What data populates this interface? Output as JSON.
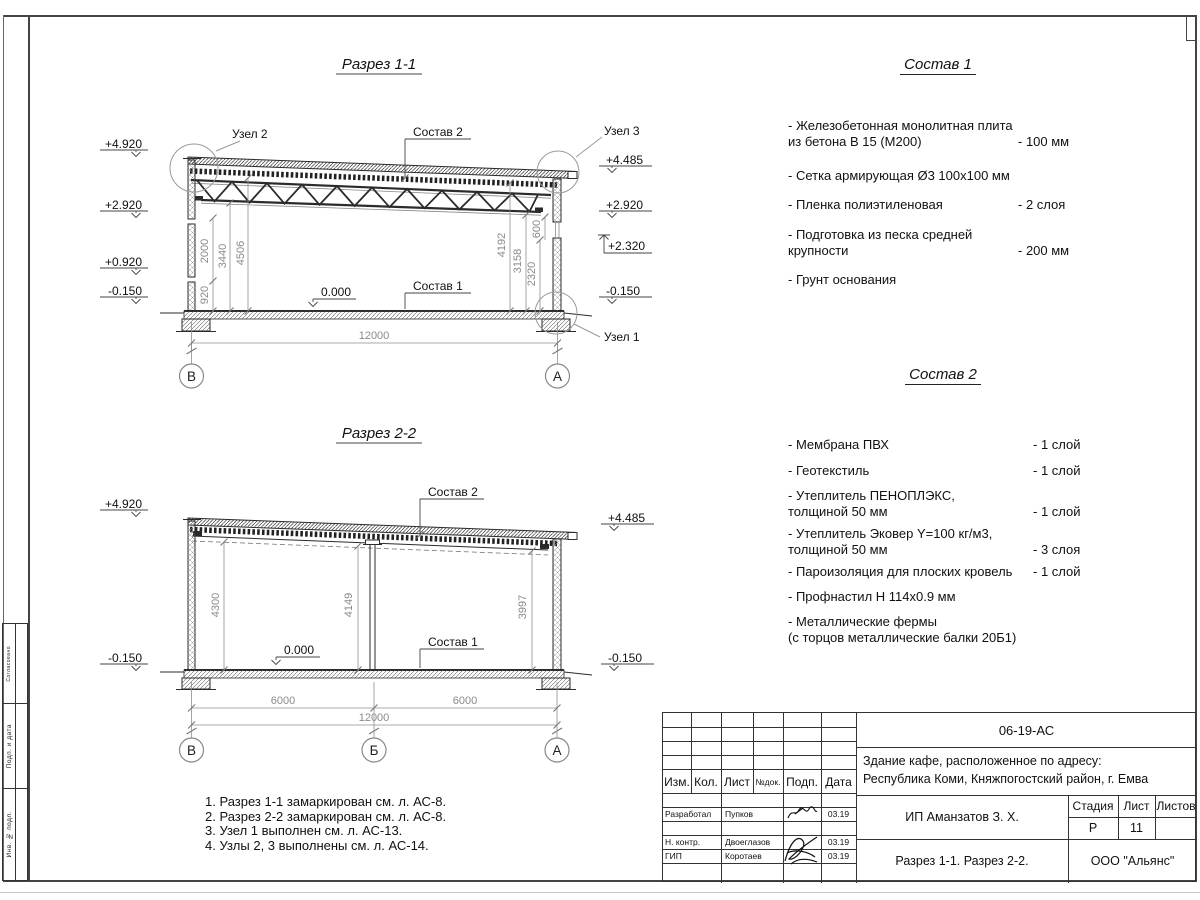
{
  "colors": {
    "ink": "#1c1c1c",
    "dim_text": "#8a8a8a",
    "frame": "#444444"
  },
  "s1": {
    "title": "Разрез 1-1",
    "elev_left": [
      "+4.920",
      "+2.920",
      "+0.920",
      "-0.150"
    ],
    "elev_right": [
      "+4.485",
      "+2.920",
      "+2.320",
      "-0.150"
    ],
    "dims_left": [
      "920",
      "2000",
      "3440",
      "4506"
    ],
    "dims_right": [
      "4192",
      "3158",
      "2320",
      "600"
    ],
    "dim_span": "12000",
    "zero_mark": "0.000",
    "label_sostav1": "Состав 1",
    "label_sostav2": "Состав 2",
    "label_uzel1": "Узел 1",
    "label_uzel2": "Узел 2",
    "label_uzel3": "Узел 3",
    "axis_left": "В",
    "axis_right": "А"
  },
  "s2": {
    "title": "Разрез 2-2",
    "elev_left": [
      "+4.920",
      "-0.150"
    ],
    "elev_right": [
      "+4.485",
      "-0.150"
    ],
    "dims_vert": [
      "4300",
      "4149",
      "3997"
    ],
    "dims_bottom": [
      "6000",
      "6000"
    ],
    "dim_span": "12000",
    "zero_mark": "0.000",
    "label_sostav1": "Состав 1",
    "label_sostav2": "Состав 2",
    "axes": [
      "В",
      "Б",
      "А"
    ]
  },
  "sostav1": {
    "title": "Состав 1",
    "items": [
      {
        "nm": "- Железобетонная  монолитная плита\nиз бетона В 15 (М200)",
        "val": "- 100 мм"
      },
      {
        "nm": "- Сетка армирующая Ø3 100х100 мм",
        "val": ""
      },
      {
        "nm": "- Пленка полиэтиленовая",
        "val": "-  2 слоя"
      },
      {
        "nm": "- Подготовка из песка средней\nкрупности",
        "val": "- 200 мм"
      },
      {
        "nm": "- Грунт основания",
        "val": ""
      }
    ]
  },
  "sostav2": {
    "title": "Состав 2",
    "items": [
      {
        "nm": "- Мембрана ПВХ",
        "val": "- 1 слой"
      },
      {
        "nm": "- Геотекстиль",
        "val": "- 1 слой"
      },
      {
        "nm": "- Утеплитель ПЕНОПЛЭКС,\nтолщиной 50 мм",
        "val": "- 1 слой"
      },
      {
        "nm": "- Утеплитель Эковер Y=100 кг/м3,\nтолщиной 50 мм",
        "val": "- 3 слоя"
      },
      {
        "nm": "- Пароизоляция для плоских кровель",
        "val": "- 1 слой"
      },
      {
        "nm": "- Профнастил Н 114х0.9 мм",
        "val": ""
      },
      {
        "nm": "- Металлические фермы\n(с торцов металлические балки 20Б1)",
        "val": ""
      }
    ]
  },
  "notes": [
    "1. Разрез 1-1 замаркирован см. л. АС-8.",
    "2. Разрез 2-2 замаркирован см. л. АС-8.",
    "3. Узел 1 выполнен см. л. АС-13.",
    "4. Узлы 2, 3 выполнены см. л. АС-14."
  ],
  "titleblock": {
    "doc_code": "06-19-АС",
    "obj1": "Здание кафе, расположенное по адресу:",
    "obj2": "Республика Коми, Княжпогостский район, г. Емва",
    "client": "ИП Аманзатов З. Х.",
    "drawing_title": "Разрез 1-1. Разрез 2-2.",
    "company": "ООО \"Альянс\"",
    "col_izm": "Изм.",
    "col_kol": "Кол.",
    "col_list": "Лист",
    "col_ndok": "№док.",
    "col_podp": "Подп.",
    "col_data": "Дата",
    "stage_label": "Стадия",
    "list_label": "Лист",
    "listov_label": "Листов",
    "stage": "Р",
    "sheet": "11",
    "sheets_total": "",
    "row1_role": "Разработал",
    "row1_name": "Пупков",
    "row1_date": "03.19",
    "row2_role": "Н. контр.",
    "row2_name": "Двоеглазов",
    "row2_date": "03.19",
    "row3_role": "ГИП",
    "row3_name": "Коротаев",
    "row3_date": "03.19"
  },
  "side_stamp": {
    "cell1": "Согласовано",
    "cell2": "Подп. и дата",
    "cell3": "Инв. № подл."
  }
}
